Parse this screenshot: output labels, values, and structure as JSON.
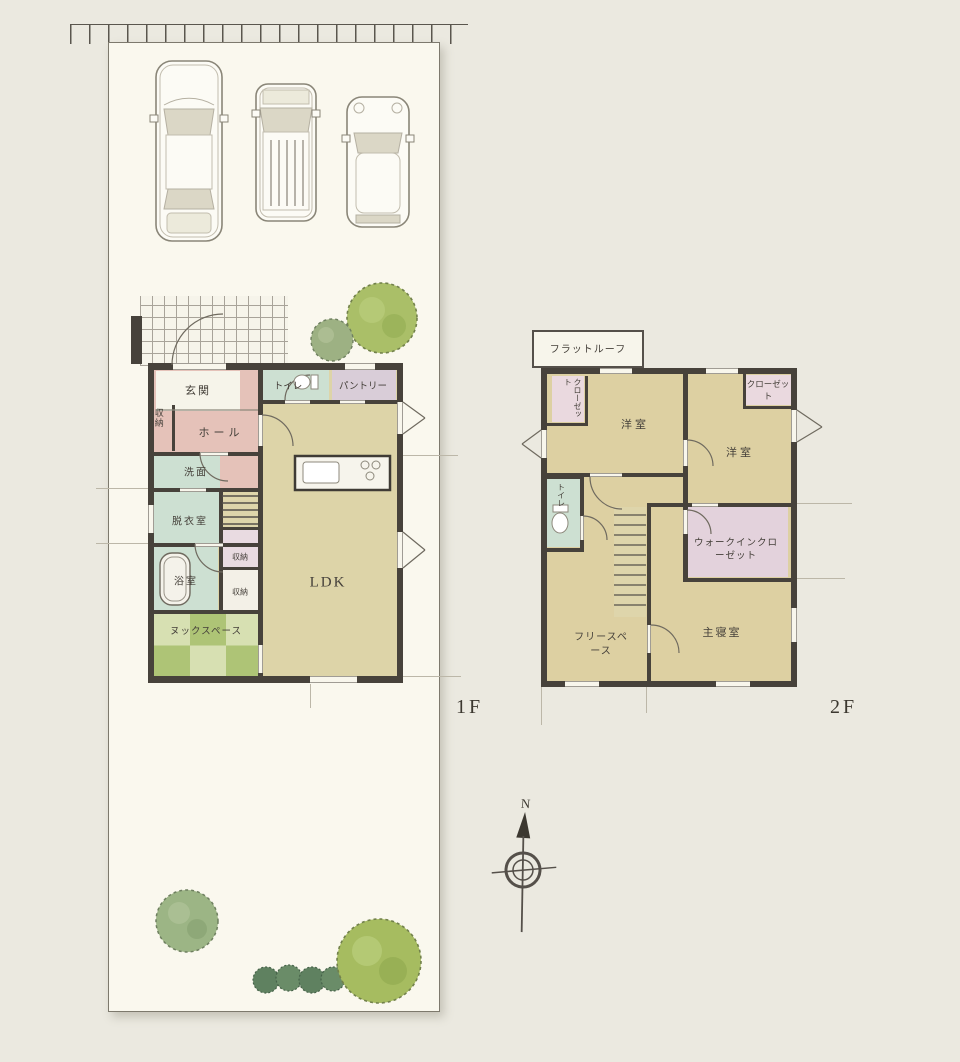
{
  "palette": {
    "wall": "#47423b",
    "room_beige": "#ddd3a6",
    "room_pink": "#e5c2b9",
    "room_mint": "#cde0d2",
    "room_lavender": "#d9cdd8",
    "nook_green_dark": "#aec476",
    "nook_green_light": "#d7e0b2",
    "plot_fill": "#faf8ee",
    "tree_green": "#a6bc60"
  },
  "floor1": {
    "floor_label": "1F",
    "rooms": {
      "genkan": "玄関",
      "toilet": "トイレ",
      "pantry": "パントリー",
      "storage_wall": "収納",
      "hall": "ホール",
      "washroom": "洗面",
      "dressing_room": "脱衣室",
      "bathroom": "浴室",
      "storage_a": "収納",
      "storage_b": "収納",
      "nook_space": "ヌックスペース",
      "ldk": "LDK"
    }
  },
  "floor2": {
    "floor_label": "2F",
    "rooms": {
      "flat_roof": "フラットルーフ",
      "closet_left": "クローゼット",
      "bedroom_left": "洋室",
      "bedroom_right": "洋室",
      "closet_right": "クローゼット",
      "toilet": "トイレ",
      "walk_in_closet": "ウォークインクローゼット",
      "master_bedroom": "主寝室",
      "free_space": "フリースペース"
    }
  },
  "compass": {
    "north": "N"
  }
}
